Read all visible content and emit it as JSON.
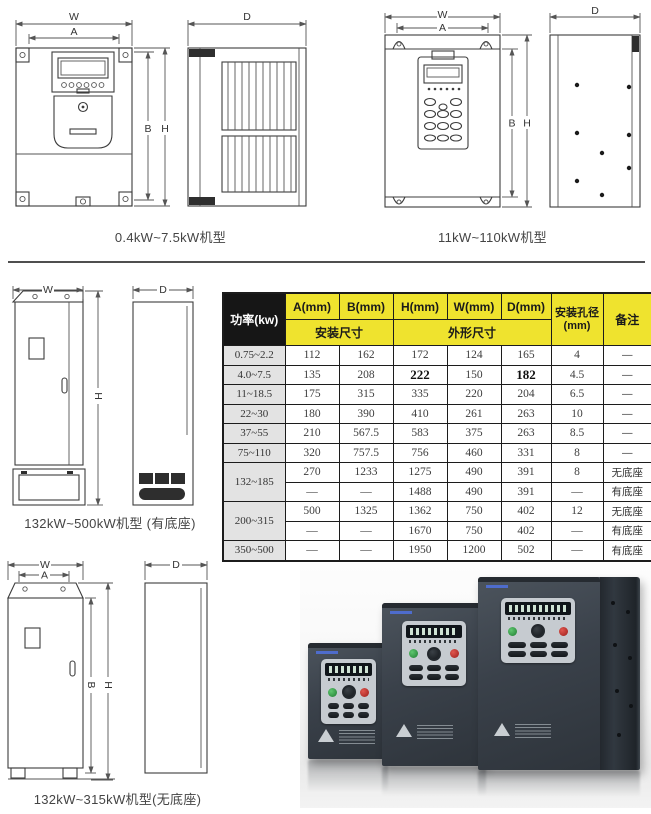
{
  "dims": {
    "w": "W",
    "a": "A",
    "b": "B",
    "h": "H",
    "d": "D"
  },
  "sections": {
    "top_left_caption": "0.4kW~7.5kW机型",
    "top_right_caption": "11kW~110kW机型",
    "mid_left_caption": "132kW~500kW机型 (有底座)",
    "bottom_left_caption": "132kW~315kW机型(无底座)"
  },
  "table": {
    "power_header": "功率(kw)",
    "col_headers": [
      "A(mm)",
      "B(mm)",
      "H(mm)",
      "W(mm)",
      "D(mm)"
    ],
    "mount_group": "安装尺寸",
    "outline_group": "外形尺寸",
    "hole_header_line1": "安装孔径",
    "hole_header_line2": "(mm)",
    "remark_header": "备注",
    "rows": [
      {
        "power": "0.75~2.2",
        "rowspan": 1,
        "cells": [
          "112",
          "162",
          "172",
          "124",
          "165",
          "4",
          "—"
        ],
        "bold": []
      },
      {
        "power": "4.0~7.5",
        "rowspan": 1,
        "cells": [
          "135",
          "208",
          "222",
          "150",
          "182",
          "4.5",
          "—"
        ],
        "bold": [
          2,
          4
        ]
      },
      {
        "power": "11~18.5",
        "rowspan": 1,
        "cells": [
          "175",
          "315",
          "335",
          "220",
          "204",
          "6.5",
          "—"
        ],
        "bold": []
      },
      {
        "power": "22~30",
        "rowspan": 1,
        "cells": [
          "180",
          "390",
          "410",
          "261",
          "263",
          "10",
          "—"
        ],
        "bold": []
      },
      {
        "power": "37~55",
        "rowspan": 1,
        "cells": [
          "210",
          "567.5",
          "583",
          "375",
          "263",
          "8.5",
          "—"
        ],
        "bold": []
      },
      {
        "power": "75~110",
        "rowspan": 1,
        "cells": [
          "320",
          "757.5",
          "756",
          "460",
          "331",
          "8",
          "—"
        ],
        "bold": []
      },
      {
        "power": "132~185",
        "rowspan": 2,
        "cells": [
          "270",
          "1233",
          "1275",
          "490",
          "391",
          "8",
          "无底座"
        ],
        "bold": []
      },
      {
        "power": null,
        "cells": [
          "—",
          "—",
          "1488",
          "490",
          "391",
          "—",
          "有底座"
        ],
        "bold": []
      },
      {
        "power": "200~315",
        "rowspan": 2,
        "cells": [
          "500",
          "1325",
          "1362",
          "750",
          "402",
          "12",
          "无底座"
        ],
        "bold": []
      },
      {
        "power": null,
        "cells": [
          "—",
          "—",
          "1670",
          "750",
          "402",
          "—",
          "有底座"
        ],
        "bold": []
      },
      {
        "power": "350~500",
        "rowspan": 1,
        "cells": [
          "—",
          "—",
          "1950",
          "1200",
          "502",
          "—",
          "有底座"
        ],
        "bold": []
      }
    ],
    "colors": {
      "header_yellow": "#efe32e",
      "header_black": "#161616",
      "row_label_gray": "#e3e3e3",
      "border": "#1c1c1c"
    }
  }
}
